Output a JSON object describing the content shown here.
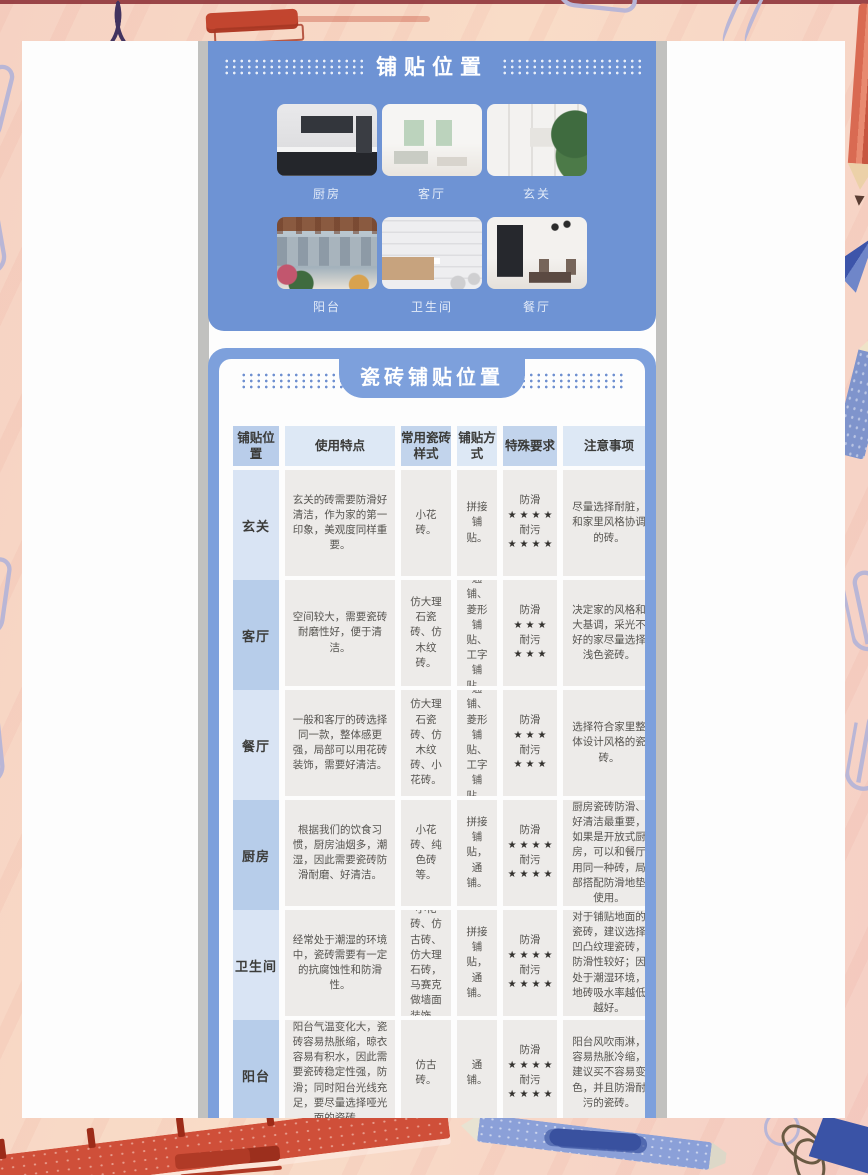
{
  "theme": {
    "card_blue": "#6e93d4",
    "card2_border_blue": "#7da0dc",
    "header_blue": "#b9cdea",
    "header_blue_light": "#dde8f5",
    "label_light": "#d9e4f4",
    "label_medium": "#b7cdea",
    "cell_gray": "#edebe9",
    "border_peach": "#f8d9c5",
    "shadow_gray": "#c1c1bf"
  },
  "photo_section": {
    "title": "铺贴位置",
    "photos": [
      {
        "label": "厨房"
      },
      {
        "label": "客厅"
      },
      {
        "label": "玄关"
      },
      {
        "label": "阳台"
      },
      {
        "label": "卫生间"
      },
      {
        "label": "餐厅"
      }
    ]
  },
  "table_section": {
    "title": "瓷砖铺贴位置",
    "headers": [
      "铺贴位置",
      "使用特点",
      "常用瓷砖样式",
      "铺贴方式",
      "特殊要求",
      "注意事项"
    ],
    "rows": [
      {
        "location": "玄关",
        "features": "玄关的砖需要防滑好清洁，作为家的第一印象，美观度同样重要。",
        "styles": "小花砖。",
        "method": "拼接铺贴。",
        "slip_label": "防滑",
        "slip_stars": "★★★★",
        "stain_label": "耐污",
        "stain_stars": "★★★★",
        "notes": "尽量选择耐脏，和家里风格协调的砖。"
      },
      {
        "location": "客厅",
        "features": "空间较大，需要瓷砖耐磨性好，便于清洁。",
        "styles": "仿大理石瓷砖、仿木纹砖。",
        "method": "通铺、菱形铺贴、工字铺贴。",
        "slip_label": "防滑",
        "slip_stars": "★★★",
        "stain_label": "耐污",
        "stain_stars": "★★★",
        "notes": "决定家的风格和大基调，采光不好的家尽量选择浅色瓷砖。"
      },
      {
        "location": "餐厅",
        "features": "一般和客厅的砖选择同一款，整体感更强，局部可以用花砖装饰，需要好清洁。",
        "styles": "仿大理石瓷砖、仿木纹砖、小花砖。",
        "method": "通铺、菱形铺贴、工字铺贴。",
        "slip_label": "防滑",
        "slip_stars": "★★★",
        "stain_label": "耐污",
        "stain_stars": "★★★",
        "notes": "选择符合家里整体设计风格的瓷砖。"
      },
      {
        "location": "厨房",
        "features": "根据我们的饮食习惯，厨房油烟多，潮湿，因此需要瓷砖防滑耐磨、好清洁。",
        "styles": "小花砖、纯色砖等。",
        "method": "拼接铺贴，通铺。",
        "slip_label": "防滑",
        "slip_stars": "★★★★",
        "stain_label": "耐污",
        "stain_stars": "★★★★",
        "notes": "厨房瓷砖防滑、好清洁最重要，如果是开放式厨房，可以和餐厅用同一种砖，局部搭配防滑地垫使用。"
      },
      {
        "location": "卫生间",
        "features": "经常处于潮湿的环境中，瓷砖需要有一定的抗腐蚀性和防滑性。",
        "styles": "小花砖、仿古砖、仿大理石砖，马赛克做墙面装饰。",
        "method": "拼接铺贴，通铺。",
        "slip_label": "防滑",
        "slip_stars": "★★★★",
        "stain_label": "耐污",
        "stain_stars": "★★★★",
        "notes": "对于铺贴地面的瓷砖，建议选择凹凸纹理瓷砖，防滑性较好；因处于潮湿环境，地砖吸水率越低越好。"
      },
      {
        "location": "阳台",
        "features": "阳台气温变化大，瓷砖容易热胀缩，晾衣容易有积水，因此需要瓷砖稳定性强，防滑；同时阳台光线充足，要尽量选择哑光面的瓷砖。",
        "styles": "仿古砖。",
        "method": "通铺。",
        "slip_label": "防滑",
        "slip_stars": "★★★★",
        "stain_label": "耐污",
        "stain_stars": "★★★★",
        "notes": "阳台风吹雨淋，容易热胀冷缩，建议买不容易变色，并且防滑耐污的瓷砖。"
      }
    ]
  },
  "decorations": [
    "paper-clip",
    "fountain-pen-squiggle",
    "red-crayon-scribble",
    "red-pencil",
    "blue-pencil",
    "paper-plane",
    "ruler",
    "red-marker",
    "blue-crayon",
    "binder-clip",
    "circle-doodle"
  ]
}
